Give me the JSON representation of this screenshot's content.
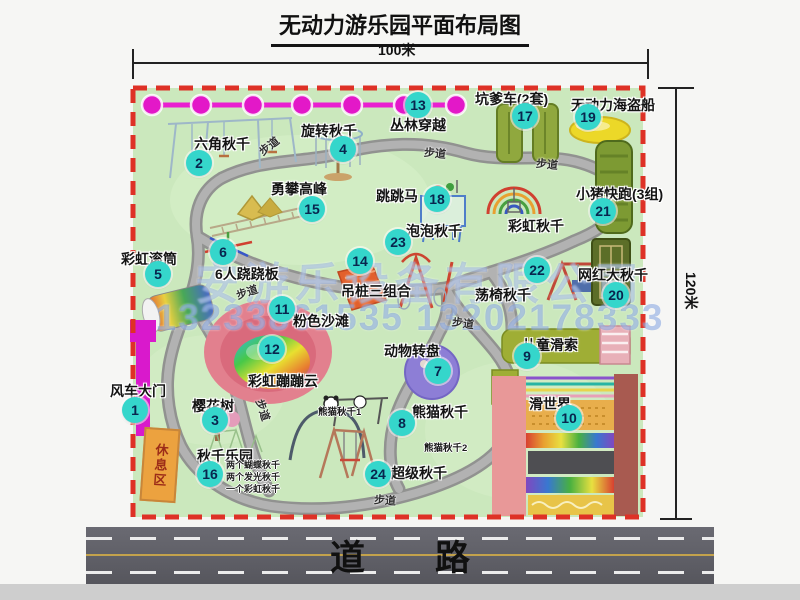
{
  "title": "无动力游乐园平面布局图",
  "dimensions": {
    "width_label": "100米",
    "height_label": "120米"
  },
  "road_label": "道　　路",
  "watermark": {
    "company": "安游乐设备有限公司",
    "phones": "13233861535 13202178333"
  },
  "rest_area_label": "休息区",
  "colors": {
    "map_green": "#cbe8bd",
    "border_red": "#de3126",
    "marker_teal": "#35d6cb",
    "magenta": "#e318c8",
    "olive": "#8ba43c",
    "road_gray": "#5a5a61",
    "watermark_blue": "#6088d6",
    "rest_orange": "#eca23f"
  },
  "map": {
    "trail_text": "步道",
    "trail_labels": [
      {
        "x": 258,
        "y": 138,
        "r": -38
      },
      {
        "x": 424,
        "y": 145,
        "r": 6
      },
      {
        "x": 536,
        "y": 156,
        "r": 6
      },
      {
        "x": 236,
        "y": 284,
        "r": -18
      },
      {
        "x": 452,
        "y": 315,
        "r": 8
      },
      {
        "x": 252,
        "y": 402,
        "r": 72
      },
      {
        "x": 374,
        "y": 492,
        "r": 4
      }
    ],
    "extra_labels": [
      {
        "text": "彩虹秋千",
        "x": 508,
        "y": 216
      }
    ],
    "attractions": [
      {
        "num": "1",
        "name": "风车大门",
        "label": {
          "x": 110,
          "y": 381
        },
        "marker": {
          "x": 135,
          "y": 410
        }
      },
      {
        "num": "2",
        "name": "六角秋千",
        "label": {
          "x": 194,
          "y": 134
        },
        "marker": {
          "x": 199,
          "y": 163
        }
      },
      {
        "num": "3",
        "name": "樱花树",
        "label": {
          "x": 192,
          "y": 396
        },
        "marker": {
          "x": 215,
          "y": 420
        }
      },
      {
        "num": "4",
        "name": "旋转秋千",
        "label": {
          "x": 301,
          "y": 121
        },
        "marker": {
          "x": 343,
          "y": 149
        }
      },
      {
        "num": "5",
        "name": "彩虹滚筒",
        "label": {
          "x": 121,
          "y": 249
        },
        "marker": {
          "x": 158,
          "y": 274
        }
      },
      {
        "num": "6",
        "name": "6人跷跷板",
        "label": {
          "x": 215,
          "y": 264
        },
        "marker": {
          "x": 223,
          "y": 252
        }
      },
      {
        "num": "7",
        "name": "动物转盘",
        "label": {
          "x": 384,
          "y": 341
        },
        "marker": {
          "x": 438,
          "y": 371
        }
      },
      {
        "num": "8",
        "name": "熊猫秋千",
        "label": {
          "x": 412,
          "y": 402
        },
        "marker": {
          "x": 402,
          "y": 423
        },
        "subs": [
          {
            "text": "熊猫秋千1",
            "x": 318,
            "y": 404
          },
          {
            "text": "熊猫秋千2",
            "x": 424,
            "y": 440
          }
        ]
      },
      {
        "num": "9",
        "name": "儿童滑索",
        "label": {
          "x": 522,
          "y": 335
        },
        "marker": {
          "x": 527,
          "y": 356
        }
      },
      {
        "num": "10",
        "name": "滑世界",
        "label": {
          "x": 529,
          "y": 394
        },
        "marker": {
          "x": 569,
          "y": 418
        }
      },
      {
        "num": "11",
        "name": "粉色沙滩",
        "label": {
          "x": 293,
          "y": 311
        },
        "marker": {
          "x": 282,
          "y": 309
        }
      },
      {
        "num": "12",
        "name": "彩虹蹦蹦云",
        "label": {
          "x": 248,
          "y": 371
        },
        "marker": {
          "x": 272,
          "y": 349
        }
      },
      {
        "num": "13",
        "name": "丛林穿越",
        "label": {
          "x": 390,
          "y": 115
        },
        "marker": {
          "x": 418,
          "y": 105
        }
      },
      {
        "num": "14",
        "name": "吊桩三组合",
        "label": {
          "x": 341,
          "y": 281
        },
        "marker": {
          "x": 360,
          "y": 261
        }
      },
      {
        "num": "15",
        "name": "勇攀高峰",
        "label": {
          "x": 271,
          "y": 179
        },
        "marker": {
          "x": 312,
          "y": 209
        }
      },
      {
        "num": "16",
        "name": "秋千乐园",
        "label": {
          "x": 197,
          "y": 446
        },
        "marker": {
          "x": 210,
          "y": 474
        },
        "notes": {
          "x": 226,
          "y": 459,
          "lines": [
            "两个蝴蝶秋千",
            "两个发光秋千",
            "一个彩虹秋千"
          ]
        }
      },
      {
        "num": "17",
        "name": "坑爹车(2套)",
        "label": {
          "x": 475,
          "y": 89
        },
        "marker": {
          "x": 525,
          "y": 116
        }
      },
      {
        "num": "18",
        "name": "跳跳马",
        "label": {
          "x": 376,
          "y": 186
        },
        "marker": {
          "x": 437,
          "y": 199
        }
      },
      {
        "num": "19",
        "name": "无动力海盗船",
        "label": {
          "x": 571,
          "y": 95
        },
        "marker": {
          "x": 588,
          "y": 117
        }
      },
      {
        "num": "20",
        "name": "网红大秋千",
        "label": {
          "x": 578,
          "y": 265
        },
        "marker": {
          "x": 616,
          "y": 295
        }
      },
      {
        "num": "21",
        "name": "小猪快跑(3组)",
        "label": {
          "x": 576,
          "y": 184
        },
        "marker": {
          "x": 603,
          "y": 211
        }
      },
      {
        "num": "22",
        "name": "荡椅秋千",
        "label": {
          "x": 475,
          "y": 285
        },
        "marker": {
          "x": 537,
          "y": 270
        }
      },
      {
        "num": "23",
        "name": "泡泡秋千",
        "label": {
          "x": 406,
          "y": 221
        },
        "marker": {
          "x": 398,
          "y": 242
        }
      },
      {
        "num": "24",
        "name": "超级秋千",
        "label": {
          "x": 391,
          "y": 463
        },
        "marker": {
          "x": 378,
          "y": 474
        }
      }
    ]
  }
}
